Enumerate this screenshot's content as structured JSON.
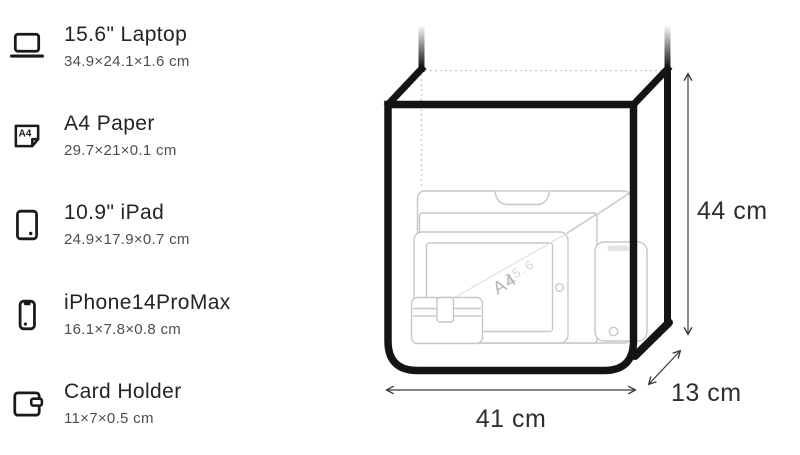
{
  "items": [
    {
      "icon": "laptop-icon",
      "title": "15.6\" Laptop",
      "dims": "34.9×24.1×1.6 cm"
    },
    {
      "icon": "a4-paper-icon",
      "title": "A4 Paper",
      "dims": "29.7×21×0.1 cm",
      "icon_label": "A4"
    },
    {
      "icon": "ipad-icon",
      "title": "10.9\" iPad",
      "dims": "24.9×17.9×0.7 cm"
    },
    {
      "icon": "iphone-icon",
      "title": "iPhone14ProMax",
      "dims": "16.1×7.8×0.8 cm"
    },
    {
      "icon": "card-holder-icon",
      "title": "Card Holder",
      "dims": "11×7×0.5 cm"
    }
  ],
  "diagram": {
    "height_label": "44 cm",
    "width_label": "41 cm",
    "depth_label": "13 cm",
    "a4_watermark": "A4",
    "laptop_watermark": "15.6"
  },
  "colors": {
    "bag_outline": "#141414",
    "item_outline": "#c7c7cb",
    "dotted_hidden_edge": "#c9c9cd",
    "arrow": "#3c3c3c",
    "title_text": "#242424",
    "subtitle_text": "#4f4f4f",
    "background": "#ffffff"
  }
}
